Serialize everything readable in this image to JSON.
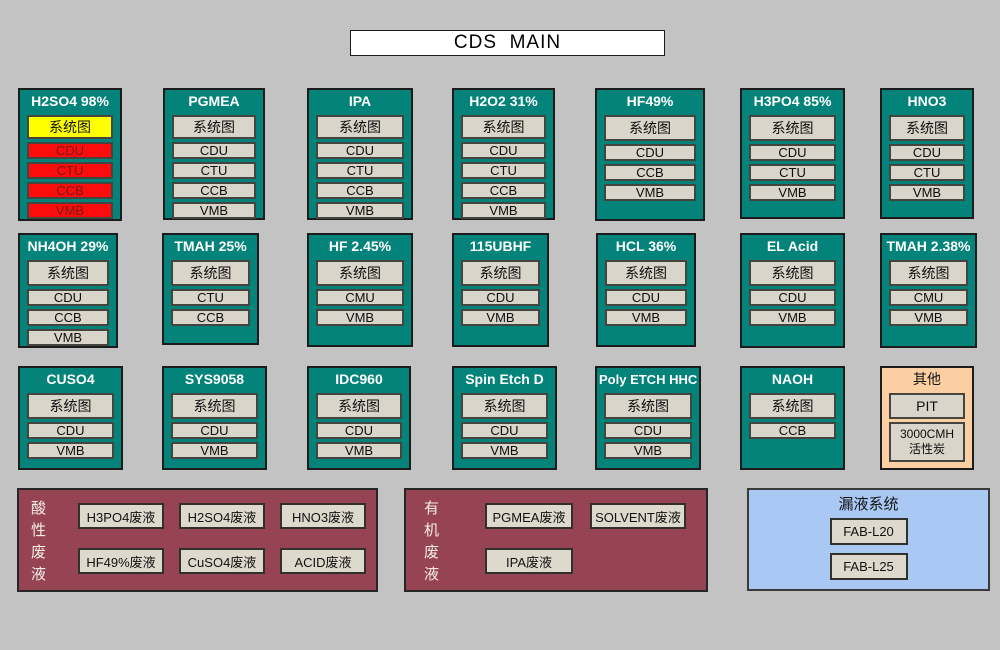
{
  "title": "CDS  MAIN",
  "colors": {
    "background": "#c3c3c3",
    "panel_teal": "#04837a",
    "button_face": "#d9d5ca",
    "alarm_yellow": "#ffff00",
    "alarm_red": "#fb0d0d",
    "waste_maroon": "#964353",
    "leak_blue": "#a9c8f4",
    "other_peach": "#fccfa3"
  },
  "panels": [
    {
      "title": "H2SO4 98%",
      "buttons": [
        "系统图",
        "CDU",
        "CTU",
        "CCB",
        "VMB"
      ]
    },
    {
      "title": "PGMEA",
      "buttons": [
        "系统图",
        "CDU",
        "CTU",
        "CCB",
        "VMB"
      ]
    },
    {
      "title": "IPA",
      "buttons": [
        "系统图",
        "CDU",
        "CTU",
        "CCB",
        "VMB"
      ]
    },
    {
      "title": "H2O2 31%",
      "buttons": [
        "系统图",
        "CDU",
        "CTU",
        "CCB",
        "VMB"
      ]
    },
    {
      "title": "HF49%",
      "buttons": [
        "系统图",
        "CDU",
        "CCB",
        "VMB"
      ]
    },
    {
      "title": "H3PO4 85%",
      "buttons": [
        "系统图",
        "CDU",
        "CTU",
        "VMB"
      ]
    },
    {
      "title": "HNO3",
      "buttons": [
        "系统图",
        "CDU",
        "CTU",
        "VMB"
      ]
    },
    {
      "title": "NH4OH 29%",
      "buttons": [
        "系统图",
        "CDU",
        "CCB",
        "VMB"
      ]
    },
    {
      "title": "TMAH 25%",
      "buttons": [
        "系统图",
        "CTU",
        "CCB"
      ]
    },
    {
      "title": "HF 2.45%",
      "buttons": [
        "系统图",
        "CMU",
        "VMB"
      ]
    },
    {
      "title": "115UBHF",
      "buttons": [
        "系统图",
        "CDU",
        "VMB"
      ]
    },
    {
      "title": "HCL 36%",
      "buttons": [
        "系统图",
        "CDU",
        "VMB"
      ]
    },
    {
      "title": "EL Acid",
      "buttons": [
        "系统图",
        "CDU",
        "VMB"
      ]
    },
    {
      "title": "TMAH 2.38%",
      "buttons": [
        "系统图",
        "CMU",
        "VMB"
      ]
    },
    {
      "title": "CUSO4",
      "buttons": [
        "系统图",
        "CDU",
        "VMB"
      ]
    },
    {
      "title": "SYS9058",
      "buttons": [
        "系统图",
        "CDU",
        "VMB"
      ]
    },
    {
      "title": "IDC960",
      "buttons": [
        "系统图",
        "CDU",
        "VMB"
      ]
    },
    {
      "title": "Spin Etch D",
      "buttons": [
        "系统图",
        "CDU",
        "VMB"
      ]
    },
    {
      "title": "Poly ETCH HHC",
      "buttons": [
        "系统图",
        "CDU",
        "VMB"
      ]
    },
    {
      "title": "NAOH",
      "buttons": [
        "系统图",
        "CCB"
      ]
    },
    {
      "title": "其他",
      "buttons": [
        "PIT",
        "3000CMH 活性炭"
      ]
    }
  ],
  "waste_acid": {
    "label": "酸性废液",
    "buttons": [
      "H3PO4废液",
      "H2SO4废液",
      "HNO3废液",
      "HF49%废液",
      "CuSO4废液",
      "ACID废液"
    ]
  },
  "waste_organic": {
    "label": "有机废液",
    "buttons": [
      "PGMEA废液",
      "SOLVENT废液",
      "IPA废液"
    ]
  },
  "leak_system": {
    "title": "漏液系统",
    "buttons": [
      "FAB-L20",
      "FAB-L25"
    ]
  }
}
